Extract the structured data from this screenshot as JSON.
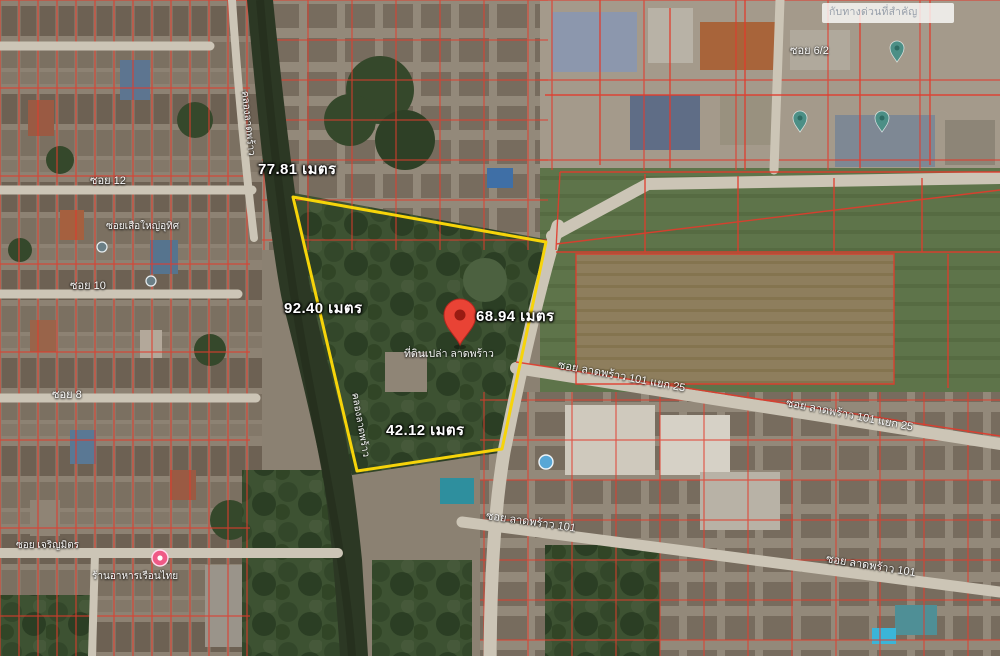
{
  "map": {
    "watermark_text": "กับทางด่วนที่สำคัญ",
    "measurements": {
      "top": "77.81 เมตร",
      "left": "92.40 เมตร",
      "right": "68.94 เมตร",
      "bottom": "42.12 เมตร"
    },
    "plot": {
      "side_lengths_m": [
        77.81,
        92.4,
        68.94,
        42.12
      ],
      "outline_color": "#f6d40a"
    },
    "pin_caption": "ที่ดินเปล่า ลาดพร้าว",
    "labels": {
      "soi12": "ซอย 12",
      "suea_yai": "ซอยเสือใหญ่อุทิศ",
      "soi10": "ซอย 10",
      "soi8": "ซอย 8",
      "canal_top": "คลองลาดพร้าว",
      "canal_bottom": "คลองลาดพร้าว",
      "lp101_yaek25_west": "ซอย ลาดพร้าว 101 แยก 25",
      "lp101_yaek25_east": "ซอย ลาดพร้าว 101 แยก 25",
      "lp101_south_west": "ซอย ลาดพร้าว 101",
      "lp101_south_east": "ซอย ลาดพร้าว 101",
      "soi_6_2": "ซอย 6/2",
      "soi_charoen": "ซอย เจริญมิตร",
      "restaurant": "ร้านอาหารเรือนไทย"
    },
    "icons": {
      "main_marker": "location-pin",
      "poi_markers": "map-pin",
      "restaurant_marker": "restaurant-dot"
    },
    "colors": {
      "parcel_line": "#e23b2c",
      "plot_outline": "#f6d40a",
      "pin_red": "#e94335",
      "canal_water": "#2c3824",
      "road": "#ccc5b6"
    }
  }
}
